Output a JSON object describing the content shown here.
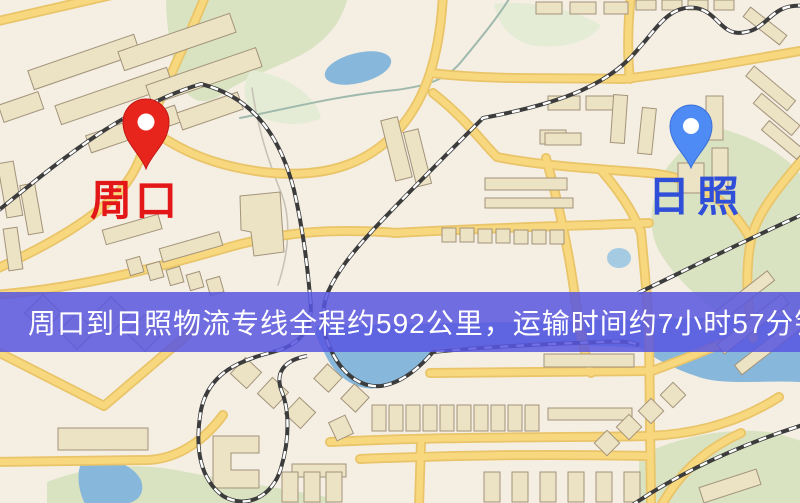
{
  "map": {
    "origin": {
      "label": "周口",
      "label_color": "#e31717",
      "marker_color": "#e8251c"
    },
    "destination": {
      "label": "日照",
      "label_color": "#2f4fd8",
      "marker_color": "#4e8bf5"
    }
  },
  "banner": {
    "text": "周口到日照物流专线全程约592公里，运输时间约7小时57分钟.",
    "distance_km": "592",
    "duration": "7小时57分钟",
    "background_color": "rgba(88,86,224,0.85)",
    "text_color": "#ffffff"
  },
  "palette": {
    "base": "#f4eee3",
    "park": "#d9e3c1",
    "park_light": "#e5ecd6",
    "water": "#87b7da",
    "pond": "#a5cbe2",
    "road": "#f8d87e",
    "road_casing": "#e9c468",
    "building": "#ece2c4",
    "building_outline": "#a3937a",
    "railway_dark": "#3c3c3c",
    "railway_light": "#ffffff",
    "stream": "#9fb9ad"
  }
}
